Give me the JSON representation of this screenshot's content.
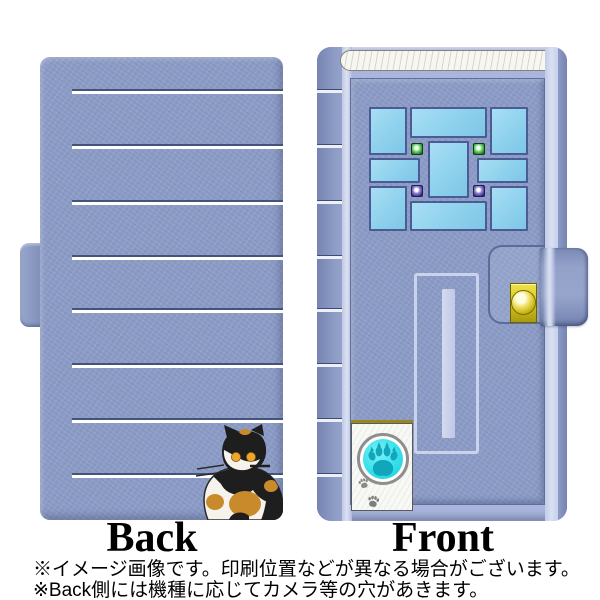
{
  "image_type": "product-photo of a notebook-style smartphone flip case, back and front views",
  "labels": {
    "back": "Back",
    "front": "Front"
  },
  "notes": {
    "line1": "※イメージ画像です。印刷位置などが異なる場合がございます。",
    "line2": "※Back側には機種に応じてカメラ等の穴があきます。"
  },
  "case_design": {
    "back": {
      "base_color": "#8C9CC6",
      "stripe_count": 8,
      "stripe_dark_color": "#44537B",
      "stripe_light_color": "#FFFFFF",
      "motif": "calico cat",
      "cat_colors": {
        "black": "#1E1E1E",
        "white": "#F6F3EC",
        "orange": "#C98A2B",
        "eyes": "#F0A42A"
      }
    },
    "front": {
      "motif": "front door with windows, mail slot, doorbell button and paw prints",
      "frame_color": "#A9B5DC",
      "face_color": "#8C9CC6",
      "spine_band_count": 8,
      "transom_color": "#F7F6F0",
      "window": {
        "pane_count": 9,
        "glass_color": "#8FD2EE",
        "frame_outline_color": "#4A5C93",
        "green_light_count": 2,
        "purple_light_count": 2,
        "green_color": "#238023",
        "purple_color": "#3A2F7E"
      },
      "mail_slot_outline_color": "#C9D3EC",
      "clasp": {
        "plate_color": "#D3C21A",
        "snap_color": "#EADB52"
      },
      "doorbell": {
        "box_color": "#F8F8F5",
        "button_color": "#35E0EA",
        "paw_color": "#12A6BC",
        "small_paw_color": "#8A8A8A"
      }
    }
  }
}
